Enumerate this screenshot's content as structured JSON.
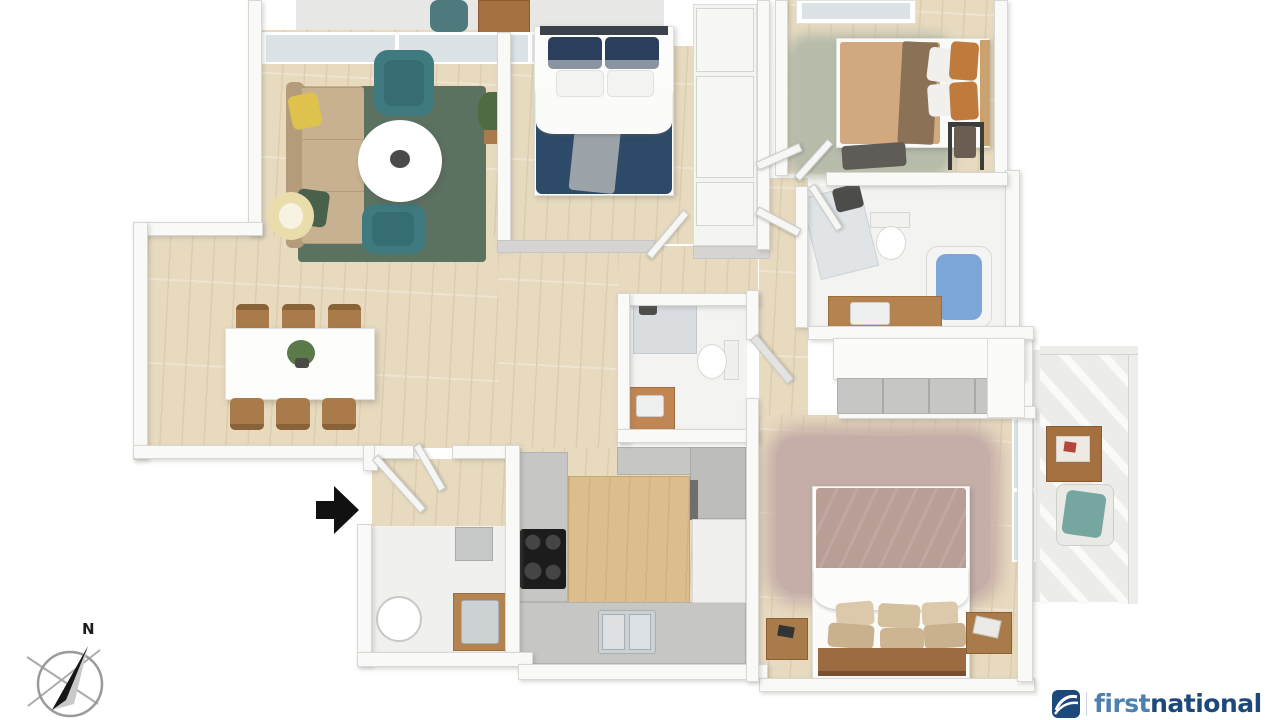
{
  "canvas": {
    "width": 1280,
    "height": 720,
    "background": "#ffffff"
  },
  "compass": {
    "label": "N"
  },
  "entry": {
    "symbol": "entry-arrow"
  },
  "branding": {
    "brand_first": "first",
    "brand_second": "national"
  },
  "floorplan": {
    "type": "3d-floor-plan",
    "rooms": [
      {
        "name": "living-room",
        "furniture": [
          "sofa",
          "armchair",
          "accent-chair",
          "round-coffee-table",
          "area-rug",
          "floor-lamp",
          "potted-plant"
        ]
      },
      {
        "name": "dining-room",
        "furniture": [
          "dining-table",
          "dining-chairs-x6",
          "table-plant"
        ]
      },
      {
        "name": "bedroom-2",
        "furniture": [
          "double-bed-navy",
          "built-in-wardrobe"
        ]
      },
      {
        "name": "bedroom-3",
        "furniture": [
          "double-bed-tan",
          "shag-rug",
          "foot-bench",
          "clothes-rack"
        ]
      },
      {
        "name": "bathroom",
        "furniture": [
          "shower",
          "toilet",
          "bathtub",
          "timber-vanity"
        ]
      },
      {
        "name": "ensuite",
        "furniture": [
          "shower",
          "toilet",
          "timber-vanity"
        ]
      },
      {
        "name": "master-bedroom",
        "furniture": [
          "double-bed-mauve",
          "shag-rug",
          "nightstand-left",
          "nightstand-right",
          "built-in-robe"
        ]
      },
      {
        "name": "kitchen",
        "furniture": [
          "cooktop",
          "double-sink",
          "timber-bench",
          "fridge",
          "tall-cabinets"
        ]
      },
      {
        "name": "laundry",
        "furniture": [
          "round-tub",
          "timber-counter-sink",
          "appliance"
        ]
      },
      {
        "name": "balcony",
        "furniture": [
          "outdoor-side-table",
          "outdoor-chair",
          "railing"
        ]
      },
      {
        "name": "top-balcony",
        "furniture": [
          "outdoor-chair",
          "outdoor-table"
        ]
      }
    ]
  },
  "colors": {
    "wall_face": "#f9f9f7",
    "wall_edge": "#d8d8d3",
    "wall_side": "#d5d4d2",
    "wood_floor": "#e7dabf",
    "wood_plank_line": "#dccdae",
    "tile_floor": "#f3f3f1",
    "laundry_floor": "#f0f0ee",
    "balcony_floor": "#ececea",
    "outdoor_floor": "#e7e7e5",
    "glass": "#dce3e7",
    "rug_green": "#5c7261",
    "rug_sage": "#b7bcab",
    "rug_mauve": "#c6aea8",
    "sofa_tan": "#c8b190",
    "sofa_back": "#b49c7a",
    "pillow_yellow": "#dfc24d",
    "pillow_green": "#49614b",
    "chair_teal": "#3e7a80",
    "table_white": "#fdfdfc",
    "lamp_cream": "#e9ddab",
    "plant_green": "#4e6b43",
    "bed_navy": "#2d4a69",
    "pillow_navy": "#2b3f5c",
    "duvet_white": "#fbfbfa",
    "throw_gray": "#9ba3a9",
    "headboard_dark": "#3c424b",
    "bed_tan": "#d2a87f",
    "throw_brown": "#8b7257",
    "pillow_orange": "#c07a3c",
    "headboard_tan": "#caa26f",
    "bench_dark": "#5f5c57",
    "bed_mauve": "#b89e95",
    "pillow_cream": "#dcc9ac",
    "pillow_khaki": "#c9b18e",
    "headboard_wood": "#9c6b42",
    "wood_furniture": "#a97b4a",
    "island_wood": "#dcbd8e",
    "counter_gray": "#c6c6c4",
    "fridge_gray": "#bdbdbb",
    "cooktop_black": "#1c1c1c",
    "sink_steel": "#ccd1d4",
    "bath_blue": "#7da6d8",
    "vanity_wood": "#b5834f",
    "fixture_dark": "#4c4c4a",
    "cushion_teal": "#76a6a0",
    "outdoor_table": "#a5703f",
    "arrow_black": "#111111",
    "compass_line": "#a7a7a7",
    "logo_navy": "#1c4979",
    "logo_blue": "#4f81af"
  }
}
